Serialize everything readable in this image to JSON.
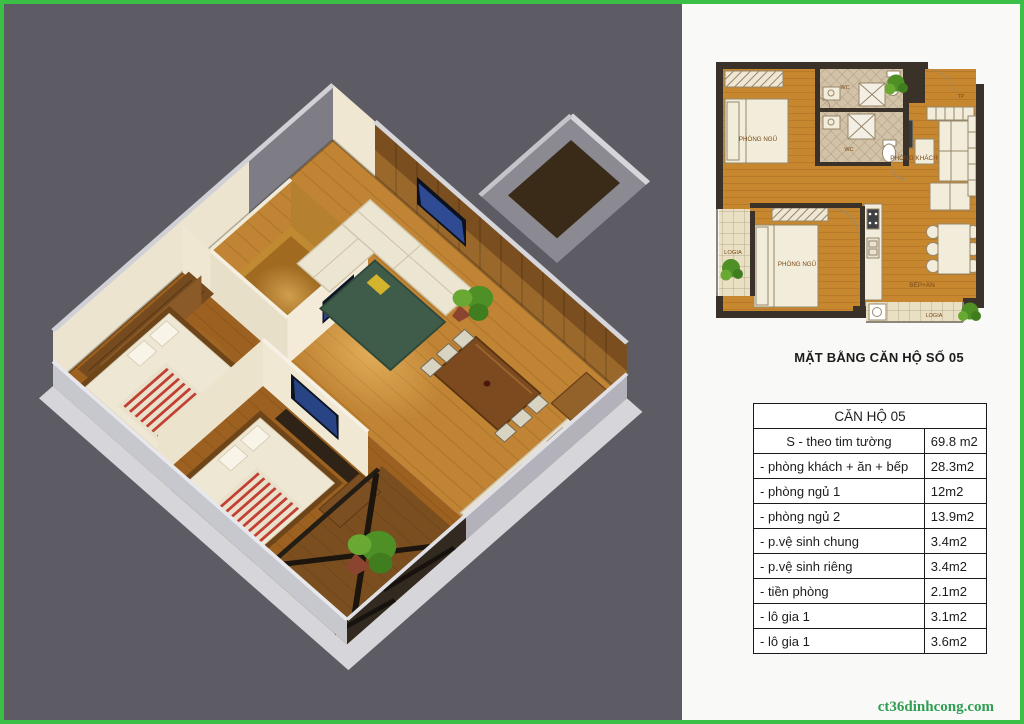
{
  "page": {
    "watermark": "ct36dinhcong.com"
  },
  "colors": {
    "border_green": "#3bbf46",
    "background_gray": "#5d5c64",
    "panel_white": "#f9f9f8",
    "wood_floor": "#c08434",
    "plan_wall_dark": "#3a3129",
    "watermark_green": "#2f9e53",
    "table_border": "#1a1a1a"
  },
  "floor_plan": {
    "title": "MẶT BẰNG CĂN HỘ SỐ 05",
    "labels": {
      "bedroom1": "PHÒNG NGỦ",
      "bedroom2": "PHÒNG NGỦ",
      "wc1": "WC",
      "wc2": "WC",
      "living": "PHÒNG KHÁCH",
      "kitchen": "BẾP+ĂN",
      "logia_left": "LOGIA",
      "logia_bottom": "LOGIA",
      "entry": "TP"
    }
  },
  "area_table": {
    "header": "CĂN HỘ 05",
    "rows": [
      {
        "label": "S - theo tim tường",
        "value": "69.8 m2"
      },
      {
        "label": "- phòng khách + ăn + bếp",
        "value": "28.3m2"
      },
      {
        "label": "- phòng ngủ 1",
        "value": "12m2"
      },
      {
        "label": "- phòng ngủ 2",
        "value": "13.9m2"
      },
      {
        "label": "- p.vệ sinh chung",
        "value": "3.4m2"
      },
      {
        "label": "- p.vệ sinh riêng",
        "value": "3.4m2"
      },
      {
        "label": "- tiền phòng",
        "value": "2.1m2"
      },
      {
        "label": "- lô gia 1",
        "value": "3.1m2"
      },
      {
        "label": "- lô gia 1",
        "value": "3.6m2"
      }
    ]
  }
}
